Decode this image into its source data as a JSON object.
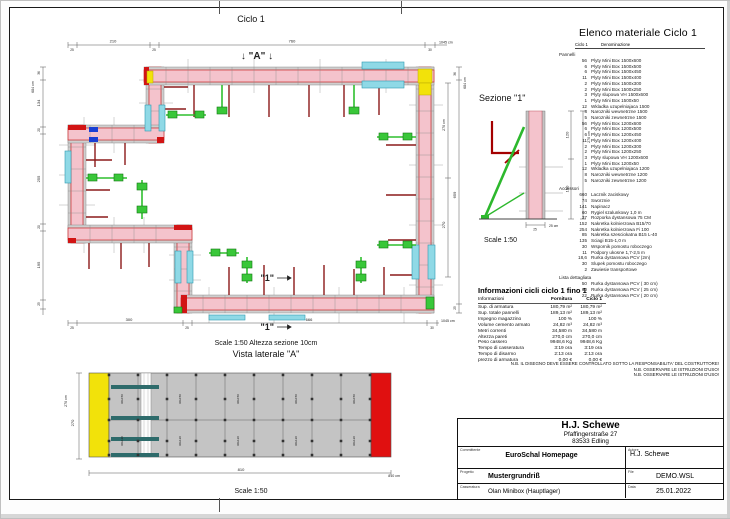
{
  "plan": {
    "title": "Ciclo 1",
    "marker_a": "↓ \"A\" ↓",
    "cut_label": "\"1\"",
    "scale_note": "Scale 1:50   Altezza sezione 10cm",
    "dims": {
      "top": [
        "25",
        "210",
        "25",
        "760",
        "30"
      ],
      "top_total": "1045 cm",
      "left": [
        "36",
        "134",
        "20",
        "255",
        "20",
        "195",
        "25"
      ],
      "left_total": "684 cm",
      "right": [
        "36",
        "659",
        "25"
      ],
      "right_inner": [
        "270 cm",
        "270"
      ],
      "right_total": "684 cm",
      "bottom": [
        "25",
        "300",
        "25",
        "666",
        "30"
      ],
      "bottom_total": "1045 cm"
    }
  },
  "vista": {
    "title": "Vista laterale \"A\"",
    "scale": "Scale 1:50",
    "dim_height_cm": "270 cm",
    "dim_height": "270",
    "dim_width": "810",
    "dim_width_cm": "810 cm",
    "panel_label_top": "90x150",
    "panel_label_bottom": "90x120"
  },
  "sezione": {
    "title": "Sezione \"1\"",
    "scale": "Scale 1:50",
    "dim_total": "270 cm",
    "dim_top": "120",
    "dim_bottom": "150",
    "dim_thickness": "25 cm",
    "dim_thickness_small": "25"
  },
  "materials": {
    "title": "Elenco materiale  Ciclo 1",
    "col_ciclo": "Ciclo 1",
    "col_denominazione": "Denominazione",
    "groups": [
      {
        "name": "Pannelli",
        "items": [
          {
            "q": "56",
            "n": "Plyty Mini Box 1500x600"
          },
          {
            "q": "6",
            "n": "Plyty Mini Box 1500x500"
          },
          {
            "q": "6",
            "n": "Plyty Mini Box 1500x450"
          },
          {
            "q": "11",
            "n": "Plyty Mini Box 1500x400"
          },
          {
            "q": "2",
            "n": "Plyty Mini Box 1500x300"
          },
          {
            "q": "2",
            "n": "Plyty Mini Box 1500x250"
          },
          {
            "q": "3",
            "n": "Plyty slupowa VH 1500x600"
          },
          {
            "q": "1",
            "n": "Plyty Mini Box 1500x50"
          },
          {
            "q": "12",
            "n": "Wkladka uzupelniajaca 1500"
          },
          {
            "q": "8",
            "n": "Narozniki wewnetrzne 1500"
          },
          {
            "q": "5",
            "n": "Narozniki zewnetrzne 1500"
          },
          {
            "q": "56",
            "n": "Plyty Mini Box 1200x600"
          },
          {
            "q": "6",
            "n": "Plyty Mini Box 1200x500"
          },
          {
            "q": "6",
            "n": "Plyty Mini Box 1200x450"
          },
          {
            "q": "11",
            "n": "Plyty Mini Box 1200x400"
          },
          {
            "q": "2",
            "n": "Plyty Mini Box 1200x300"
          },
          {
            "q": "2",
            "n": "Plyty Mini Box 1200x250"
          },
          {
            "q": "3",
            "n": "Plyty slupowa VH 1200x600"
          },
          {
            "q": "1",
            "n": "Plyty Mini Box 1200x50"
          },
          {
            "q": "12",
            "n": "Wkladka uzupelniajaca 1200"
          },
          {
            "q": "8",
            "n": "Narozniki wewnetrzne 1200"
          },
          {
            "q": "5",
            "n": "Narozniki zewnetrzne 1200"
          }
        ]
      },
      {
        "name": "Accessori",
        "items": [
          {
            "q": "660",
            "n": "Lacznik zaciskowy"
          },
          {
            "q": "74",
            "n": "Sworznie"
          },
          {
            "q": "141",
            "n": "Napinacz"
          },
          {
            "q": "60",
            "n": "Rygiel szalunkowy 1,0 m"
          },
          {
            "q": "37",
            "n": "Rozporka dystansowa 75 CM"
          },
          {
            "q": "152",
            "n": "Nakretka kolnierzowa B15/70"
          },
          {
            "q": "254",
            "n": "Nakretka kolnierzowa Fi 100"
          },
          {
            "q": "85",
            "n": "Nakretka szesciokatna B15 L-40"
          },
          {
            "q": "135",
            "n": "Sciagi B15-1,0 m"
          },
          {
            "q": "30",
            "n": "Wspornik pomostu roboczego"
          },
          {
            "q": "11",
            "n": "Podpory ukosne 1,7-2,5 m"
          },
          {
            "q": "18,6",
            "n": "Rurka dystansowa PCV (2m)"
          },
          {
            "q": "30",
            "n": "Slupek pomostu roboczego"
          },
          {
            "q": "2",
            "n": "Zawiesie transportowe"
          }
        ]
      },
      {
        "name": "Lista dettagliata",
        "items": [
          {
            "q": "50",
            "n": "Rurka dystansowa PCV ( 30 cm)"
          },
          {
            "q": "60",
            "n": "Rurka dystansowa PCV ( 25 cm)"
          },
          {
            "q": "22",
            "n": "Rurka dystansowa PCV ( 20 cm)"
          }
        ]
      }
    ]
  },
  "info": {
    "title": "Informazioni cicli  ciclo 1 fino 1",
    "headers": [
      "Informazioni",
      "Fornitura",
      "Ciclo 1"
    ],
    "rows": [
      [
        "Sup. di armatura",
        "180,79 m²",
        "180,79 m²"
      ],
      [
        "Sup. totale pannelli",
        "189,13 m²",
        "189,13 m²"
      ],
      [
        "Impegno magazzino",
        "100 %",
        "100 %"
      ],
      [
        "Volume cemento armato",
        "24,82 m³",
        "24,82 m³"
      ],
      [
        "Metri correnti",
        "34,580 m",
        "34,580 m"
      ],
      [
        "Altezza pareti",
        "270,0 cm",
        "270,0 cm"
      ],
      [
        "Peso cassero",
        "9948,6 Kg",
        "9948,6 Kg"
      ],
      [
        "Tempo di casseratura",
        "3:19 ora",
        "3:19 ora"
      ],
      [
        "Tempo di disarmo",
        "2:13 ora",
        "2:13 ora"
      ],
      [
        "prezzo di armatura",
        "0,00 €",
        "0,00 €"
      ]
    ]
  },
  "notes": [
    "N.B. IL DISEGNO DEVE ESSERE CONTROLLATO SOTTO LA RESPONSABILITA' DEL COSTRUTTORE!",
    "N.B. OSSERVARE LE ISTRUZIONI D'USO!",
    "N.B. OSSERVARE LE ISTRUZIONI D'USO!"
  ],
  "titleblock": {
    "company": "H.J. Schewe",
    "address1": "Pfaffingerstraße 27",
    "address2": "83533 Edling",
    "committente_label": "Committente",
    "committente": "EuroSchal Homepage",
    "autore_label": "Autore",
    "autore": "H.J. Schewe",
    "progetto_label": "Progetto",
    "progetto": "Mustergrundriß",
    "file_label": "File",
    "file": "DEMO.WSL",
    "casseratura_label": "Casseratura",
    "casseratura": "Olan Minibox (Hauptlager)",
    "data_label": "Data",
    "data": "25.01.2022"
  }
}
